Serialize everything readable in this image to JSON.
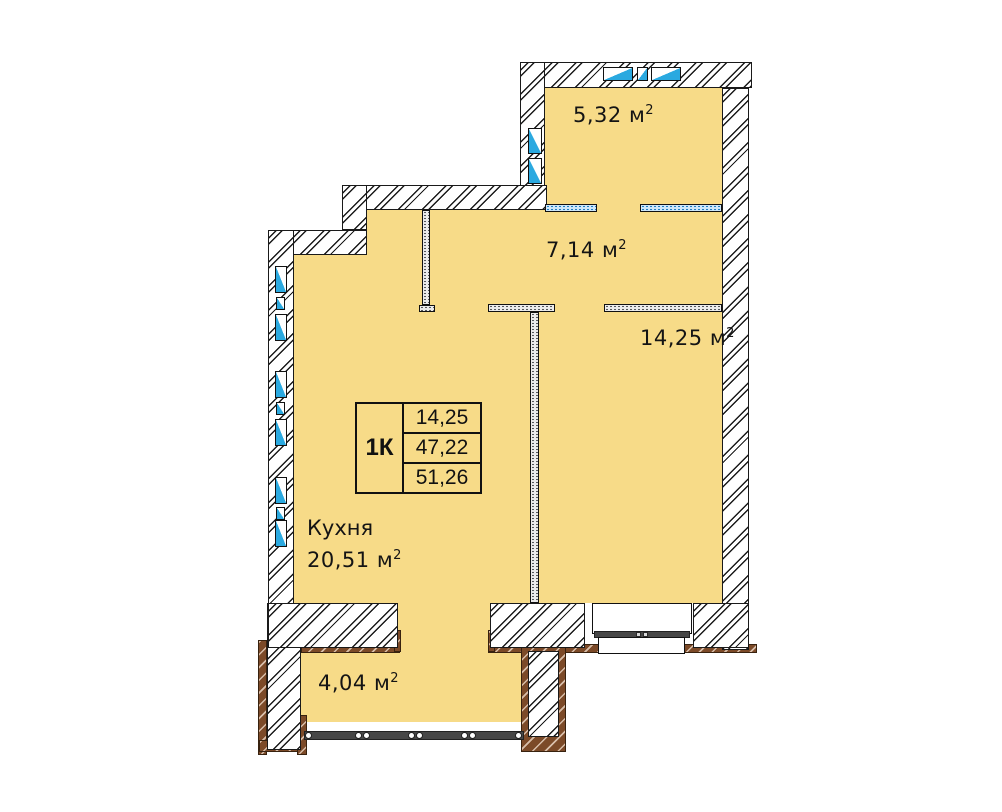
{
  "colors": {
    "floor_fill": "#F7DB88",
    "window_blue": "#2AA9E0",
    "balcony_brown": "#7C4A28",
    "wall_outline": "#1A1A1A"
  },
  "units": {
    "symbol": "м",
    "exponent": "2"
  },
  "rooms": {
    "bathroom": {
      "area": "5,32"
    },
    "hallway": {
      "area": "7,14"
    },
    "living": {
      "area": "14,25"
    },
    "kitchen": {
      "name": "Кухня",
      "area": "20,51"
    },
    "balcony": {
      "area": "4,04"
    }
  },
  "info_table": {
    "type": "1К",
    "values": [
      "14,25",
      "47,22",
      "51,26"
    ]
  }
}
